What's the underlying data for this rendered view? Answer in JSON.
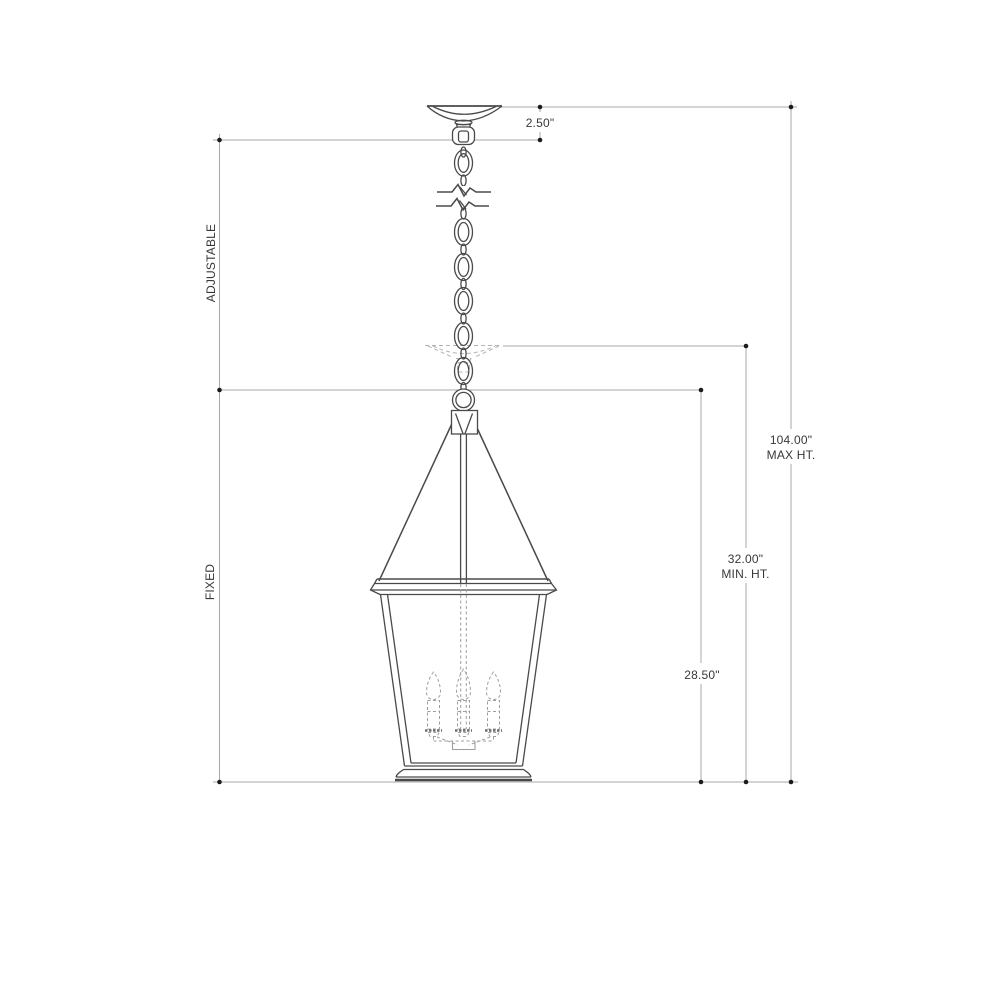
{
  "drawing": {
    "background_color": "#ffffff",
    "fixture_line_color": "#4a4a4a",
    "dimension_line_color": "#a8a8a8",
    "dashed_ghost_color": "#b3b3b3",
    "text_color": "#383838",
    "labels": {
      "canopy_drop": "2.50\"",
      "adjustable": "ADJUSTABLE",
      "fixed": "FIXED",
      "max_ht_value": "104.00\"",
      "max_ht_text": "MAX HT.",
      "min_ht_value": "32.00\"",
      "min_ht_text": "MIN. HT.",
      "fixture_ht": "28.50\""
    }
  }
}
